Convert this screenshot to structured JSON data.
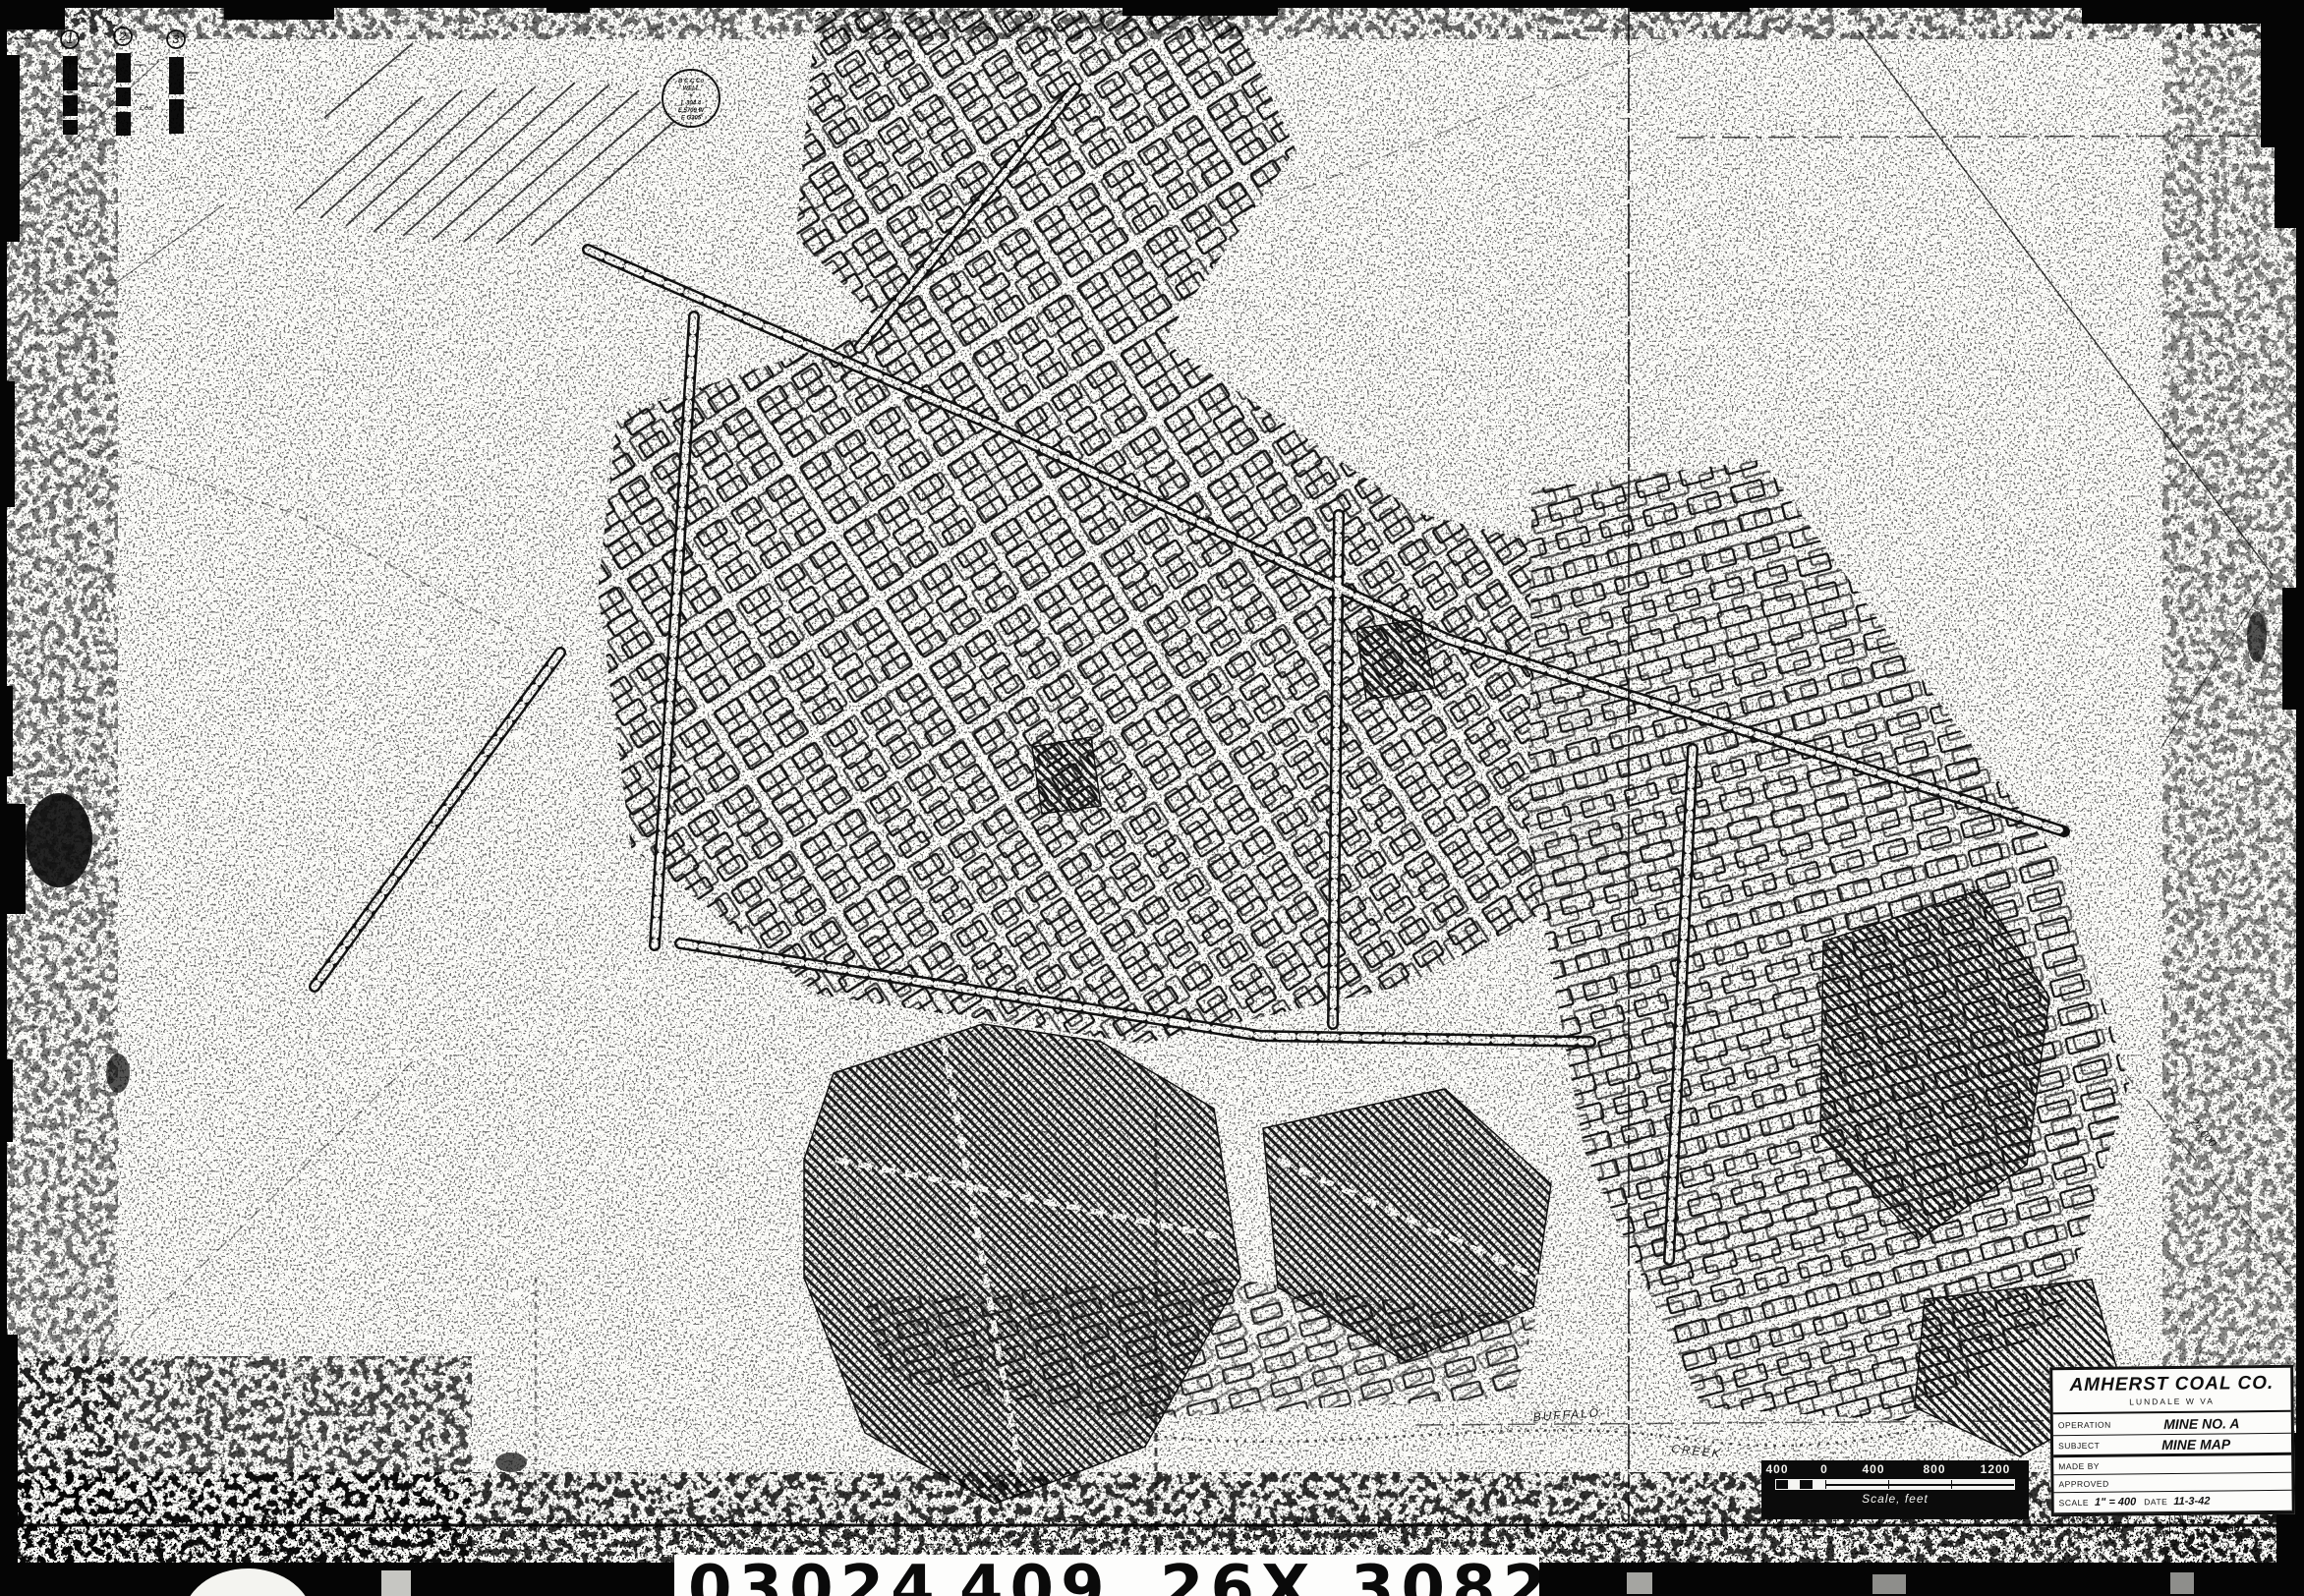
{
  "colors": {
    "ink": "#111111",
    "paper": "#fbfbf8"
  },
  "title_block": {
    "company": "AMHERST COAL CO.",
    "location": "LUNDALE  W VA",
    "operation_label": "OPERATION",
    "operation_value": "MINE NO. A",
    "subject_label": "SUBJECT",
    "subject_value": "MINE MAP",
    "made_by_label": "MADE BY",
    "approved_label": "APPROVED",
    "scale_label": "SCALE",
    "scale_value": "1\" = 400",
    "date_label": "DATE",
    "date_value": "11-3-42",
    "changes_label": "CHANGES",
    "changes_value": "5700",
    "file_label": "FILE NO.",
    "file_value": "A-601"
  },
  "scale_bar": {
    "ticks": [
      "400",
      "0",
      "400",
      "800",
      "1200"
    ],
    "caption": "Scale, feet"
  },
  "film_strip": {
    "numbers": [
      "03024",
      "409",
      "26X",
      "308232"
    ]
  },
  "drill_logs": {
    "labels": [
      "1",
      "2",
      "3"
    ],
    "coal_note": "Coal"
  },
  "stamp": {
    "lines": [
      "B C C Co",
      "WELL",
      "#",
      "L 304 4",
      "E 5709 W",
      "E G305"
    ]
  },
  "annotations": {
    "creek_upper": "BUFFALO",
    "creek_lower": "CREEK",
    "survey_label": "24,000"
  }
}
